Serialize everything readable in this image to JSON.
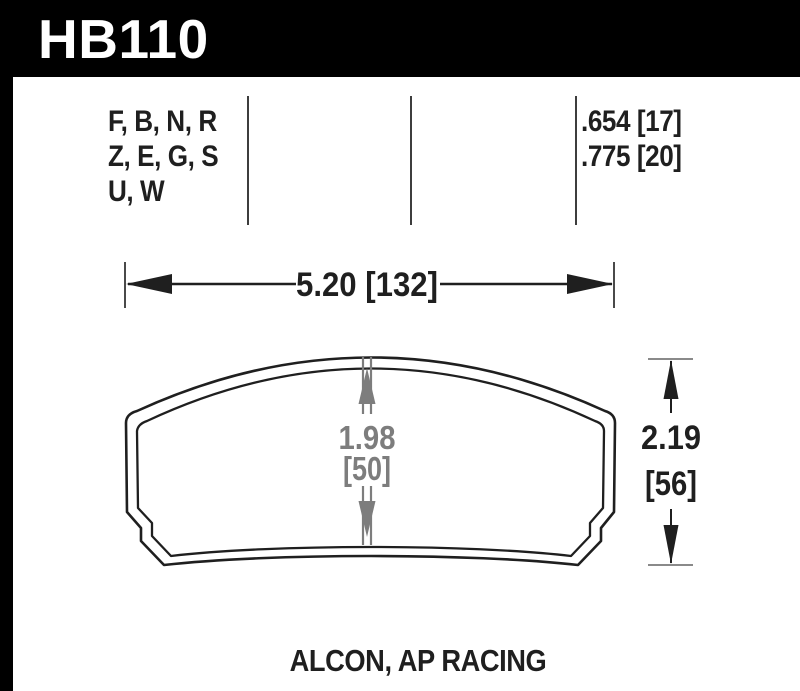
{
  "page": {
    "colors": {
      "header_bg": "#000000",
      "header_text": "#ffffff",
      "ink": "#1f1f1f",
      "dimension_gray": "#7d7d7d",
      "background": "#ffffff"
    }
  },
  "header": {
    "part_number": "HB110"
  },
  "compound_table": {
    "compound_groups": [
      "F, B, N, R",
      "Z, E, G, S",
      "U, W"
    ],
    "pad_thicknesses": [
      ".654 [17]",
      ".775 [20]"
    ]
  },
  "dimensions": {
    "overall_width": "5.20 [132]",
    "overall_height_in": "2.19",
    "overall_height_mm": "[56]",
    "center_height_in": "1.98",
    "center_height_mm": "[50]"
  },
  "footer": {
    "caliper_applications": "ALCON, AP RACING"
  }
}
